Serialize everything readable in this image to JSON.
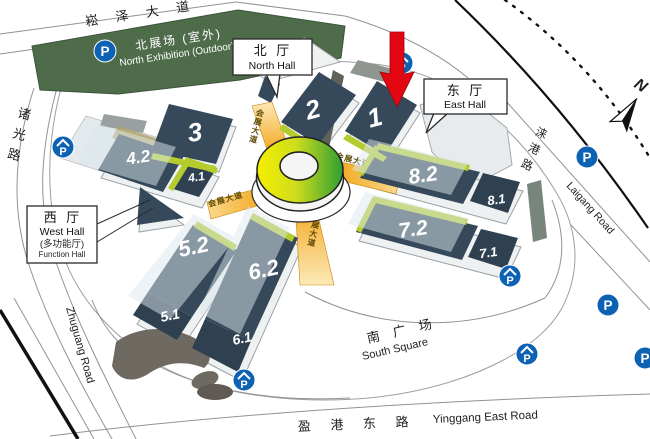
{
  "map": {
    "roads": {
      "songze_avenue": "崧 泽 大 道",
      "zhuguang_cn": "诸光路",
      "zhuguang_en": "Zhuguang Road",
      "yinggang_cn": "盈 港 东 路",
      "yinggang_en": "Yinggang East Road",
      "laigang_cn": "涞港路",
      "laigang_en": "Laigang Road"
    },
    "north_exhibition": {
      "cn": "北展场 (室外)",
      "en": "North Exhibition (Outdoor)"
    },
    "south_square": {
      "cn": "南 广 场",
      "en": "South Square"
    },
    "callouts": {
      "north_hall": {
        "cn": "北 厅",
        "en": "North Hall"
      },
      "east_hall": {
        "cn": "东 厅",
        "en": "East Hall"
      },
      "west_hall": {
        "cn": "西 厅",
        "en": "West Hall",
        "sub_cn": "(多功能厅)",
        "sub_en": "Function Hall"
      }
    },
    "halls": {
      "h1": "1",
      "h2": "2",
      "h3": "3",
      "h41": "4.1",
      "h42": "4.2",
      "h51": "5.1",
      "h52": "5.2",
      "h61": "6.1",
      "h62": "6.2",
      "h71": "7.1",
      "h72": "7.2",
      "h81": "8.1",
      "h82": "8.2"
    },
    "walkway_label": "会展大道",
    "compass_label": "N",
    "parking_label": "P",
    "colors": {
      "hall_fill": "#35495a",
      "walkway_orange": "#f3a81f",
      "accent_green": "#b5cc2e",
      "ring_yellow": "#f5ef00",
      "ring_green": "#2f9e33",
      "parking_blue": "#0e62b4",
      "arrow_red": "#e30613",
      "outdoor_green": "#4e6b4a"
    }
  }
}
